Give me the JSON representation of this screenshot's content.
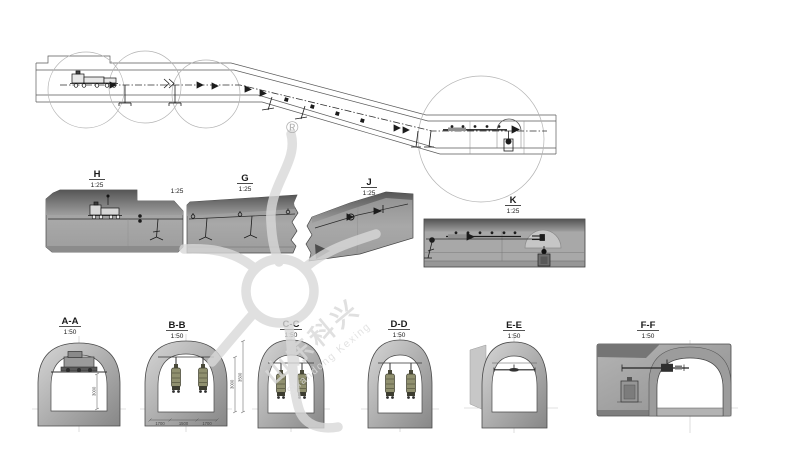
{
  "watermark": {
    "registered_mark": "®",
    "brand_cn": "山东科兴",
    "brand_en": "Shandong Kexing"
  },
  "plan_details": [
    {
      "id": "H",
      "scale": "1:25"
    },
    {
      "id": "G",
      "scale": "1:25"
    },
    {
      "id": "J",
      "scale": "1:25"
    },
    {
      "id": "K",
      "scale": "1:25"
    }
  ],
  "inline_scale_label": "1:25",
  "cross_sections": [
    {
      "id": "A-A",
      "scale": "1:50"
    },
    {
      "id": "B-B",
      "scale": "1:50"
    },
    {
      "id": "C-C",
      "scale": "1:50"
    },
    {
      "id": "D-D",
      "scale": "1:50"
    },
    {
      "id": "E-E",
      "scale": "1:50"
    },
    {
      "id": "F-F",
      "scale": "1:50"
    }
  ],
  "dimensions": {
    "aa_height": "3000",
    "bb_height_inner": "3000",
    "bb_height_outer": "3500",
    "bb_widths": [
      "1700",
      "1500",
      "1700"
    ]
  },
  "colors": {
    "background": "#ffffff",
    "line": "#333333",
    "slab_gray": "#a5a5a5",
    "slab_dark": "#585858",
    "ring_light": "#d6d6d6",
    "ring_dark": "#878787",
    "equipment_olive": "#90906f",
    "watermark_gray": "#d9d9d9"
  }
}
